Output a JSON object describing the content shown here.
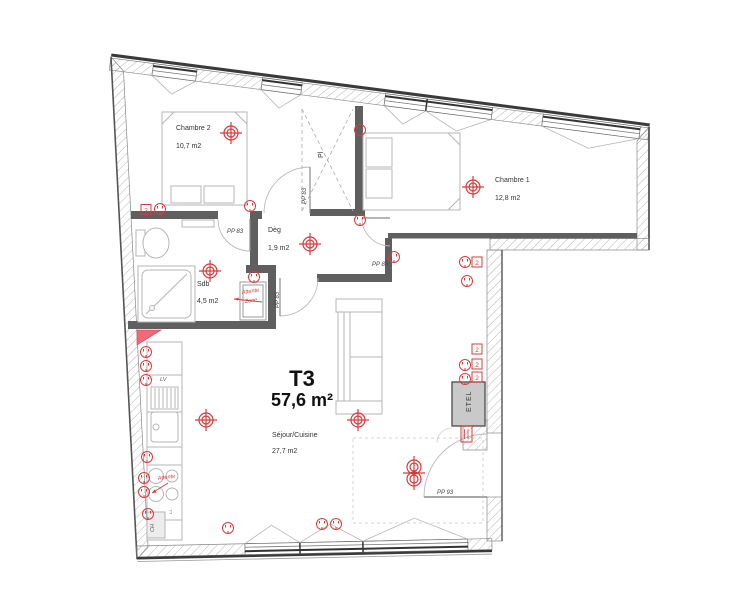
{
  "plan": {
    "title": "T3",
    "total_area": "57,6 m²",
    "rooms": {
      "chambre2": {
        "name": "Chambre 2",
        "area": "10,7 m2"
      },
      "chambre1": {
        "name": "Chambre 1",
        "area": "12,8 m2"
      },
      "degagement": {
        "name": "Dèg",
        "area": "1,9 m2"
      },
      "sdb": {
        "name": "Sdb",
        "area": "4,5 m2"
      },
      "sejour": {
        "name": "Séjour/Cuisine",
        "area": "27,7 m2"
      },
      "placard": {
        "name": "Pl"
      }
    },
    "doors": {
      "sdb": "PP 83",
      "chambre2": "PP 83",
      "chambre1": "PP 83",
      "sejour": "PP 83",
      "entrance": "PP 93"
    },
    "equipment": {
      "dishwasher": "LV",
      "water_heater": "CH",
      "washing_machine": "LL",
      "electrical_box": "ETEL"
    },
    "annotations": {
      "niche_line1": "Attente",
      "niche_line2": "Zone",
      "cooktop_note": "Attente"
    },
    "outlet_badge": "2",
    "colors": {
      "symbol_red": "#d63c3c",
      "wall_dark": "#5f5f5f",
      "hatch_gray": "#adadad",
      "accent_pink": "#f4687c"
    }
  }
}
